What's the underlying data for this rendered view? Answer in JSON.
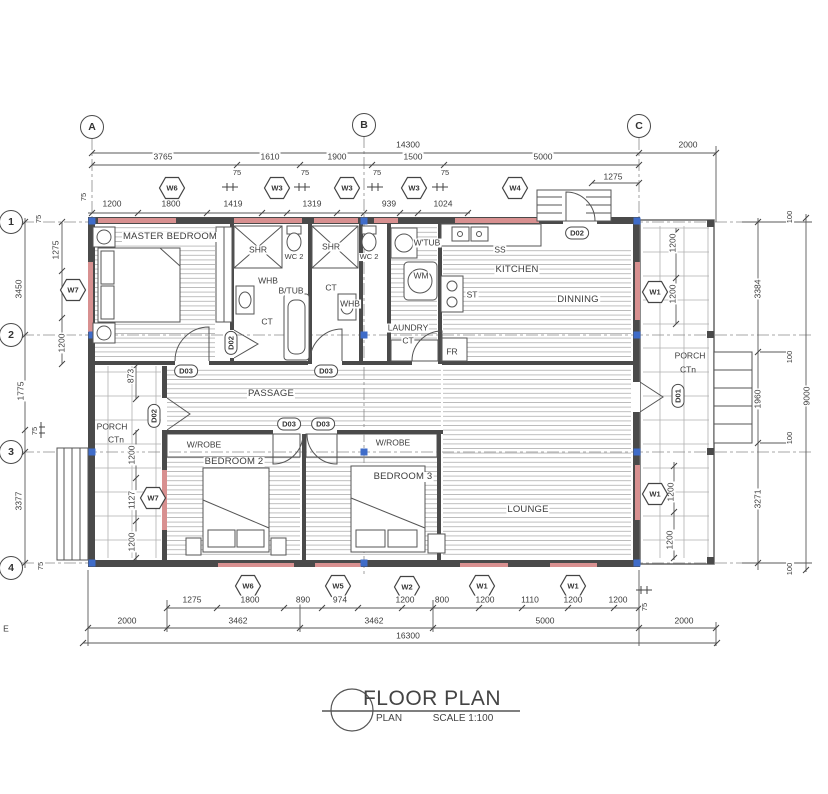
{
  "page": {
    "stray_label": "E"
  },
  "title_block": {
    "title": "FLOOR PLAN",
    "name": "PLAN",
    "scale": "SCALE 1:100"
  },
  "grid": {
    "cols": [
      "A",
      "B",
      "C"
    ],
    "rows": [
      "1",
      "2",
      "3",
      "4"
    ]
  },
  "rooms": {
    "master": "MASTER BEDROOM",
    "kitchen": "KITCHEN",
    "dinning": "DINNING",
    "passage": "PASSAGE",
    "bedroom2": "BEDROOM 2",
    "bedroom3": "BEDROOM 3",
    "lounge": "LOUNGE",
    "laundry1": "LAUNDRY",
    "laundry2": "CT",
    "wrobe_bed2": "W/ROBE",
    "wrobe_bed3": "W/ROBE",
    "porch_left1": "PORCH",
    "porch_left2": "CTn",
    "porch_right1": "PORCH",
    "porch_right2": "CTn"
  },
  "fixtures": {
    "shr_ensuite": "SHR",
    "wc_ensuite": "WC 2",
    "whb_ensuite": "WHB",
    "btub": "B/TUB",
    "ct_ensuite": "CT",
    "shr_bath": "SHR",
    "wc_bath": "WC 2",
    "ct_bath": "CT",
    "whb_bath": "WHB",
    "wtub": "W'TUB",
    "wm": "WM",
    "fr": "FR",
    "ss": "SS",
    "st": "ST"
  },
  "window_tags": {
    "top": [
      "W6",
      "W3",
      "W3",
      "W3",
      "W4"
    ],
    "left_wall": "W7",
    "porch_left": "W7",
    "right_top": "W1",
    "right_bottom": "W1",
    "bottom": [
      "W6",
      "W5",
      "W2",
      "W1",
      "W1"
    ]
  },
  "door_tags": {
    "kitchen": "D02",
    "master": "D02",
    "porch_left": "D02",
    "front": "D01",
    "passage": [
      "D03",
      "D03",
      "D03",
      "D03"
    ]
  },
  "dims": {
    "top": {
      "total": "14300",
      "right_ext": "2000",
      "row2": [
        "3765",
        "1610",
        "1900",
        "1500",
        "5000"
      ],
      "wall75": [
        "75",
        "75",
        "75",
        "75"
      ],
      "left75": "75",
      "c1275": "1275",
      "row3": [
        "1200",
        "1800",
        "1419",
        "1319",
        "939",
        "1024"
      ]
    },
    "left": {
      "t75": "75",
      "v1275": "1275",
      "v3450": "3450",
      "v1200": "1200",
      "v1775": "1775",
      "m75": "75",
      "v3377": "3377",
      "b75": "75"
    },
    "porch_left": {
      "v873": "873",
      "v1200a": "1200",
      "v1127": "1127",
      "v1200b": "1200"
    },
    "right": {
      "p100": [
        "100",
        "100",
        "100",
        "100"
      ],
      "v3384": "3384",
      "v1960": "1960",
      "v3271": "3271",
      "total": "9000",
      "porch_top": [
        "1200",
        "1200"
      ],
      "porch_bottom": [
        "1200",
        "1200"
      ]
    },
    "bottom": {
      "row1": [
        "1275",
        "1800",
        "890",
        "974",
        "1200",
        "800",
        "1200",
        "1110",
        "1200",
        "1200"
      ],
      "w75": "75",
      "row2": [
        "2000",
        "3462",
        "3462",
        "5000",
        "2000"
      ],
      "total": "16300"
    }
  }
}
